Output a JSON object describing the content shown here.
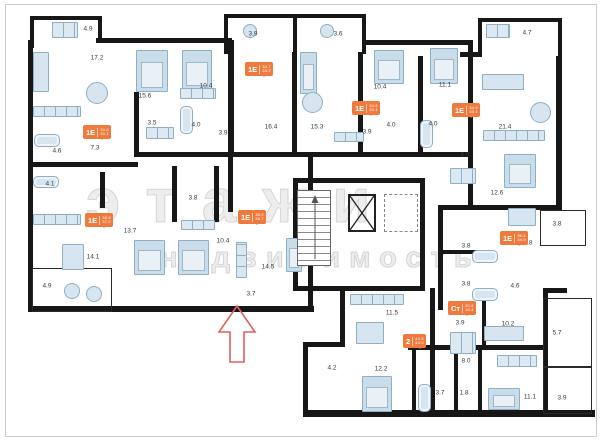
{
  "meta": {
    "wall_color": "#171717",
    "accent_orange": "#ee7a3d",
    "furniture_fill": "#d6e5f0",
    "furniture_stroke": "#8fafc4",
    "label_color": "#2e3d48",
    "arrow_color": "#e06060",
    "frame_color": "#cccccc"
  },
  "watermark": {
    "line1": "этажи",
    "line2": "недвижимость"
  },
  "rooms": [
    {
      "x": 88,
      "y": 29,
      "label": "4.9"
    },
    {
      "x": 253,
      "y": 34,
      "label": "3.9"
    },
    {
      "x": 338,
      "y": 34,
      "label": "3.6"
    },
    {
      "x": 527,
      "y": 33,
      "label": "4.7"
    },
    {
      "x": 97,
      "y": 58,
      "label": "17.2"
    },
    {
      "x": 145,
      "y": 96,
      "label": "15.6"
    },
    {
      "x": 206,
      "y": 86,
      "label": "10.4"
    },
    {
      "x": 380,
      "y": 87,
      "label": "10.4"
    },
    {
      "x": 445,
      "y": 85,
      "label": "11.1"
    },
    {
      "x": 152,
      "y": 123,
      "label": "3.5"
    },
    {
      "x": 196,
      "y": 125,
      "label": "4.0"
    },
    {
      "x": 223,
      "y": 133,
      "label": "3.9"
    },
    {
      "x": 271,
      "y": 127,
      "label": "16.4"
    },
    {
      "x": 317,
      "y": 127,
      "label": "15.3"
    },
    {
      "x": 367,
      "y": 132,
      "label": "3.9"
    },
    {
      "x": 391,
      "y": 125,
      "label": "4.0"
    },
    {
      "x": 433,
      "y": 124,
      "label": "4.0"
    },
    {
      "x": 505,
      "y": 127,
      "label": "21.4"
    },
    {
      "x": 57,
      "y": 151,
      "label": "4.6"
    },
    {
      "x": 95,
      "y": 148,
      "label": "7.3"
    },
    {
      "x": 465,
      "y": 155,
      "label": "6.6"
    },
    {
      "x": 50,
      "y": 184,
      "label": "4.1"
    },
    {
      "x": 193,
      "y": 198,
      "label": "3.8"
    },
    {
      "x": 497,
      "y": 193,
      "label": "12.6"
    },
    {
      "x": 130,
      "y": 231,
      "label": "13.7"
    },
    {
      "x": 223,
      "y": 241,
      "label": "10.4"
    },
    {
      "x": 557,
      "y": 224,
      "label": "3.8"
    },
    {
      "x": 528,
      "y": 243,
      "label": "9.8"
    },
    {
      "x": 466,
      "y": 246,
      "label": "3.8"
    },
    {
      "x": 93,
      "y": 257,
      "label": "14.1"
    },
    {
      "x": 268,
      "y": 267,
      "label": "14.5"
    },
    {
      "x": 466,
      "y": 284,
      "label": "3.8"
    },
    {
      "x": 515,
      "y": 286,
      "label": "4.6"
    },
    {
      "x": 47,
      "y": 286,
      "label": "4.9"
    },
    {
      "x": 251,
      "y": 294,
      "label": "3.7"
    },
    {
      "x": 392,
      "y": 313,
      "label": "11.5"
    },
    {
      "x": 460,
      "y": 323,
      "label": "3.9"
    },
    {
      "x": 508,
      "y": 324,
      "label": "10.2"
    },
    {
      "x": 557,
      "y": 333,
      "label": "5.7"
    },
    {
      "x": 466,
      "y": 361,
      "label": "8.0"
    },
    {
      "x": 332,
      "y": 368,
      "label": "4.2"
    },
    {
      "x": 381,
      "y": 369,
      "label": "12.2"
    },
    {
      "x": 440,
      "y": 393,
      "label": "3.7"
    },
    {
      "x": 464,
      "y": 393,
      "label": "1.8"
    },
    {
      "x": 530,
      "y": 397,
      "label": "11.1"
    },
    {
      "x": 562,
      "y": 398,
      "label": "3.9"
    }
  ],
  "units": [
    {
      "x": 83,
      "y": 125,
      "type": "1Е",
      "area1": "34.6",
      "area2": "33.1"
    },
    {
      "x": 245,
      "y": 62,
      "type": "1Е",
      "area1": "34.7",
      "area2": "33.2"
    },
    {
      "x": 352,
      "y": 101,
      "type": "1Е",
      "area1": "34.6",
      "area2": "33.1"
    },
    {
      "x": 452,
      "y": 103,
      "type": "1Е",
      "area1": "34.9",
      "area2": "33.4"
    },
    {
      "x": 85,
      "y": 213,
      "type": "1Е",
      "area1": "38.5",
      "area2": "37.0"
    },
    {
      "x": 238,
      "y": 210,
      "type": "1Е",
      "area1": "38.2",
      "area2": "36.7"
    },
    {
      "x": 500,
      "y": 231,
      "type": "1Е",
      "area1": "36.4",
      "area2": "34.9"
    },
    {
      "x": 448,
      "y": 301,
      "type": "Ст",
      "area1": "20.9",
      "area2": "19.4"
    },
    {
      "x": 403,
      "y": 334,
      "type": "2",
      "area1": "44.5",
      "area2": "43.0"
    }
  ],
  "walls": [
    [
      30,
      16,
      72,
      4
    ],
    [
      30,
      16,
      4,
      32
    ],
    [
      98,
      16,
      4,
      24
    ],
    [
      96,
      38,
      136,
      5
    ],
    [
      224,
      14,
      142,
      4
    ],
    [
      224,
      14,
      4,
      40
    ],
    [
      293,
      14,
      4,
      40
    ],
    [
      362,
      14,
      4,
      40
    ],
    [
      362,
      40,
      110,
      5
    ],
    [
      478,
      18,
      84,
      4
    ],
    [
      478,
      18,
      4,
      38
    ],
    [
      558,
      18,
      4,
      42
    ],
    [
      460,
      52,
      22,
      5
    ],
    [
      28,
      40,
      5,
      126
    ],
    [
      134,
      92,
      5,
      64
    ],
    [
      228,
      40,
      6,
      116
    ],
    [
      292,
      52,
      5,
      104
    ],
    [
      358,
      52,
      5,
      104
    ],
    [
      418,
      56,
      5,
      100
    ],
    [
      468,
      40,
      5,
      168
    ],
    [
      556,
      56,
      6,
      152
    ],
    [
      134,
      152,
      336,
      5
    ],
    [
      28,
      162,
      110,
      5
    ],
    [
      28,
      162,
      5,
      150
    ],
    [
      100,
      172,
      5,
      36
    ],
    [
      172,
      166,
      5,
      56
    ],
    [
      214,
      166,
      5,
      56
    ],
    [
      228,
      156,
      5,
      56
    ],
    [
      28,
      306,
      286,
      6
    ],
    [
      308,
      156,
      5,
      156
    ],
    [
      293,
      178,
      132,
      5
    ],
    [
      293,
      178,
      5,
      112
    ],
    [
      420,
      178,
      5,
      112
    ],
    [
      293,
      286,
      132,
      5
    ],
    [
      438,
      205,
      124,
      5
    ],
    [
      438,
      205,
      5,
      105
    ],
    [
      438,
      250,
      46,
      4
    ],
    [
      543,
      288,
      24,
      5
    ],
    [
      543,
      288,
      5,
      126
    ],
    [
      340,
      288,
      5,
      58
    ],
    [
      303,
      342,
      42,
      5
    ],
    [
      303,
      342,
      5,
      74
    ],
    [
      303,
      410,
      292,
      7
    ],
    [
      430,
      288,
      5,
      124
    ],
    [
      408,
      345,
      136,
      5
    ],
    [
      412,
      350,
      4,
      60
    ],
    [
      454,
      350,
      4,
      60
    ],
    [
      478,
      350,
      4,
      60
    ],
    [
      482,
      290,
      4,
      55
    ]
  ],
  "balconies": [
    [
      32,
      268,
      78,
      42
    ],
    [
      540,
      210,
      44,
      34
    ],
    [
      543,
      298,
      47,
      68
    ],
    [
      543,
      366,
      47,
      46
    ]
  ],
  "furniture": [
    {
      "kind": "sq",
      "x": 52,
      "y": 22,
      "w": 26,
      "h": 16
    },
    {
      "kind": "tableC",
      "x": 243,
      "y": 24,
      "w": 14,
      "h": 14
    },
    {
      "kind": "tableC",
      "x": 320,
      "y": 24,
      "w": 14,
      "h": 14
    },
    {
      "kind": "sq",
      "x": 486,
      "y": 24,
      "w": 24,
      "h": 14
    },
    {
      "kind": "sofa",
      "x": 33,
      "y": 52,
      "w": 16,
      "h": 40
    },
    {
      "kind": "tableC",
      "x": 86,
      "y": 82,
      "w": 22,
      "h": 22
    },
    {
      "kind": "strip",
      "x": 33,
      "y": 106,
      "w": 48,
      "h": 11
    },
    {
      "kind": "bed",
      "x": 136,
      "y": 50,
      "w": 32,
      "h": 42
    },
    {
      "kind": "bed",
      "x": 182,
      "y": 50,
      "w": 30,
      "h": 40
    },
    {
      "kind": "sq",
      "x": 180,
      "y": 88,
      "w": 36,
      "h": 11
    },
    {
      "kind": "tub",
      "x": 34,
      "y": 134,
      "w": 26,
      "h": 13
    },
    {
      "kind": "bed",
      "x": 300,
      "y": 52,
      "w": 17,
      "h": 42
    },
    {
      "kind": "tableC",
      "x": 302,
      "y": 92,
      "w": 21,
      "h": 21
    },
    {
      "kind": "strip",
      "x": 334,
      "y": 132,
      "w": 30,
      "h": 10
    },
    {
      "kind": "bed",
      "x": 374,
      "y": 50,
      "w": 30,
      "h": 34
    },
    {
      "kind": "bed",
      "x": 430,
      "y": 48,
      "w": 28,
      "h": 36
    },
    {
      "kind": "sofa",
      "x": 482,
      "y": 74,
      "w": 42,
      "h": 16
    },
    {
      "kind": "tableC",
      "x": 530,
      "y": 102,
      "w": 21,
      "h": 21
    },
    {
      "kind": "strip",
      "x": 483,
      "y": 130,
      "w": 62,
      "h": 11
    },
    {
      "kind": "tub",
      "x": 420,
      "y": 120,
      "w": 13,
      "h": 28
    },
    {
      "kind": "tub",
      "x": 180,
      "y": 106,
      "w": 13,
      "h": 28
    },
    {
      "kind": "sq",
      "x": 146,
      "y": 127,
      "w": 28,
      "h": 12
    },
    {
      "kind": "strip",
      "x": 33,
      "y": 214,
      "w": 48,
      "h": 11
    },
    {
      "kind": "tub",
      "x": 33,
      "y": 176,
      "w": 26,
      "h": 12
    },
    {
      "kind": "bed",
      "x": 134,
      "y": 240,
      "w": 31,
      "h": 35
    },
    {
      "kind": "bed",
      "x": 178,
      "y": 240,
      "w": 31,
      "h": 35
    },
    {
      "kind": "sq",
      "x": 181,
      "y": 220,
      "w": 34,
      "h": 10
    },
    {
      "kind": "sofa",
      "x": 62,
      "y": 244,
      "w": 22,
      "h": 26
    },
    {
      "kind": "tableC",
      "x": 64,
      "y": 283,
      "w": 16,
      "h": 16
    },
    {
      "kind": "tableC",
      "x": 86,
      "y": 286,
      "w": 16,
      "h": 16
    },
    {
      "kind": "bed",
      "x": 286,
      "y": 238,
      "w": 16,
      "h": 34
    },
    {
      "kind": "stripV",
      "x": 236,
      "y": 242,
      "w": 11,
      "h": 36
    },
    {
      "kind": "bed",
      "x": 504,
      "y": 154,
      "w": 32,
      "h": 34
    },
    {
      "kind": "sq",
      "x": 450,
      "y": 168,
      "w": 26,
      "h": 16
    },
    {
      "kind": "tableR",
      "x": 508,
      "y": 208,
      "w": 28,
      "h": 18
    },
    {
      "kind": "tub",
      "x": 472,
      "y": 250,
      "w": 26,
      "h": 13
    },
    {
      "kind": "tub",
      "x": 472,
      "y": 288,
      "w": 26,
      "h": 13
    },
    {
      "kind": "strip",
      "x": 350,
      "y": 294,
      "w": 54,
      "h": 11
    },
    {
      "kind": "tableR",
      "x": 356,
      "y": 322,
      "w": 28,
      "h": 22
    },
    {
      "kind": "bed",
      "x": 362,
      "y": 376,
      "w": 30,
      "h": 36
    },
    {
      "kind": "sofa",
      "x": 484,
      "y": 326,
      "w": 40,
      "h": 15
    },
    {
      "kind": "bed",
      "x": 488,
      "y": 388,
      "w": 32,
      "h": 22
    },
    {
      "kind": "tub",
      "x": 418,
      "y": 384,
      "w": 13,
      "h": 28
    },
    {
      "kind": "sq",
      "x": 450,
      "y": 332,
      "w": 26,
      "h": 22
    },
    {
      "kind": "sq",
      "x": 497,
      "y": 355,
      "w": 40,
      "h": 12
    }
  ]
}
